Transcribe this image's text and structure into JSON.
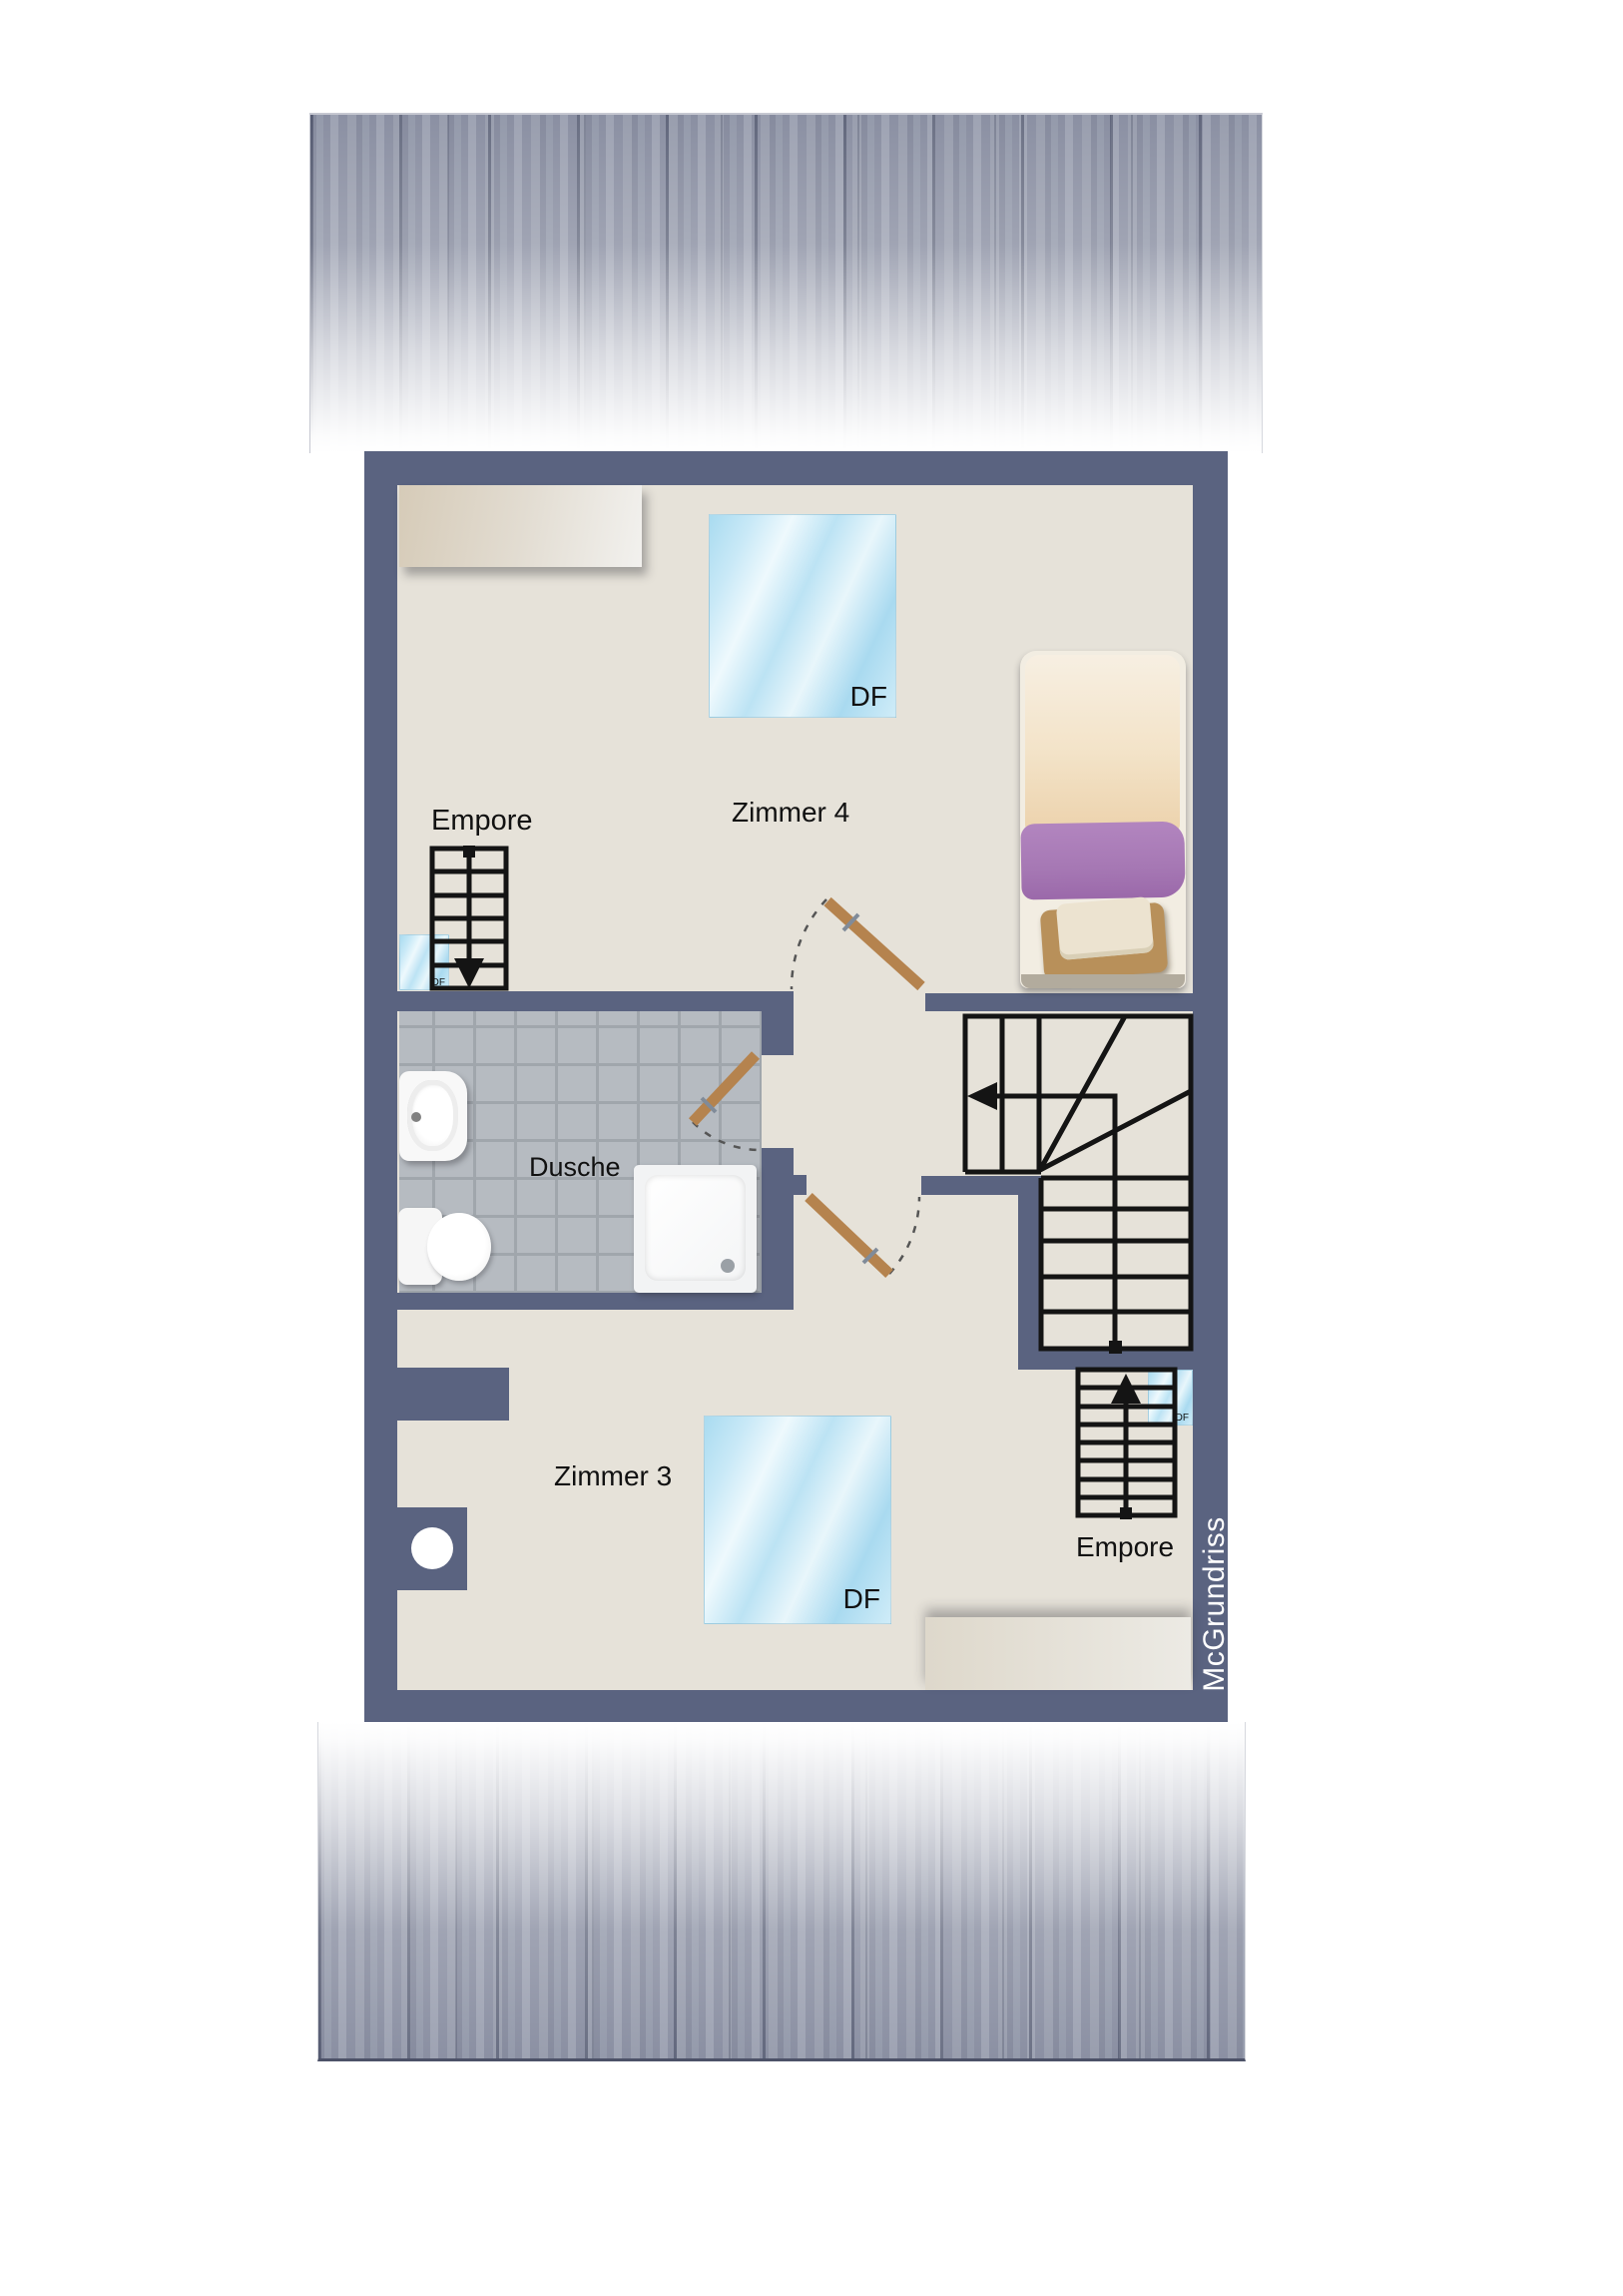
{
  "watermark": "McGrundriss",
  "rooms": {
    "zimmer4": {
      "label": "Zimmer 4"
    },
    "zimmer3": {
      "label": "Zimmer 3"
    },
    "dusche": {
      "label": "Dusche"
    },
    "empore_top": {
      "label": "Empore"
    },
    "empore_bottom": {
      "label": "Empore"
    }
  },
  "skylights": {
    "zimmer4_label": "DF",
    "zimmer3_label": "DF",
    "top_small_label": "DF",
    "bottom_small_label": "DF"
  },
  "colors": {
    "wall": "#5a6380",
    "floor": "#e6e2d9",
    "tile": "#b6bbc1",
    "tile_grout": "#a0a6ac",
    "skylight_blue": "#aadcf1",
    "door_wood": "#b5834e",
    "stair_line": "#141414",
    "roof_band": "#8e93a6",
    "bed_blanket_purple": "#a678b4",
    "bed_pillow_tan": "#b8905a",
    "furniture_beige": "#d6cbb8",
    "watermark_text": "#ffffff"
  }
}
